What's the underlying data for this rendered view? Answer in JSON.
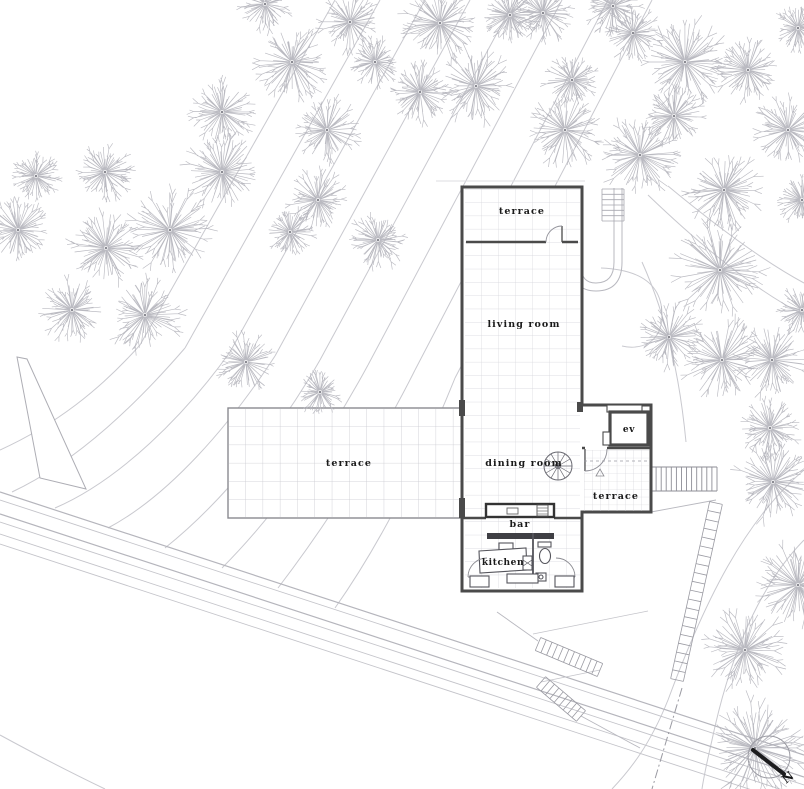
{
  "plan": {
    "rooms": [
      {
        "id": "terrace-top",
        "label": "terrace"
      },
      {
        "id": "living-room",
        "label": "living room"
      },
      {
        "id": "dining-room",
        "label": "dining room"
      },
      {
        "id": "terrace-west",
        "label": "terrace"
      },
      {
        "id": "terrace-east",
        "label": "terrace"
      },
      {
        "id": "bar",
        "label": "bar"
      },
      {
        "id": "kitchen",
        "label": "kitchen"
      },
      {
        "id": "elevator",
        "label": "ev"
      }
    ],
    "north_label": "N"
  },
  "colors": {
    "wall": "#4a4a4a",
    "grid_line": "#d4d4da",
    "terrace_grid": "#c9c9cf",
    "contour": "#c9c9cf",
    "road": "#bfbfc6",
    "tree": "#b2b2ba",
    "tree_center": "#8a8a92",
    "stair": "#9a9aa2",
    "label_text": "#1a1a1a",
    "north_arrow": "#1c1c1e"
  },
  "trees": [
    {
      "x": 265,
      "y": 4,
      "r": 26
    },
    {
      "x": 292,
      "y": 62,
      "r": 34
    },
    {
      "x": 350,
      "y": 22,
      "r": 28
    },
    {
      "x": 375,
      "y": 62,
      "r": 24
    },
    {
      "x": 222,
      "y": 112,
      "r": 30
    },
    {
      "x": 327,
      "y": 130,
      "r": 30
    },
    {
      "x": 36,
      "y": 176,
      "r": 22
    },
    {
      "x": 105,
      "y": 172,
      "r": 26
    },
    {
      "x": 222,
      "y": 172,
      "r": 36
    },
    {
      "x": 318,
      "y": 200,
      "r": 28
    },
    {
      "x": 18,
      "y": 230,
      "r": 28
    },
    {
      "x": 170,
      "y": 230,
      "r": 38
    },
    {
      "x": 106,
      "y": 248,
      "r": 34
    },
    {
      "x": 290,
      "y": 232,
      "r": 22
    },
    {
      "x": 378,
      "y": 240,
      "r": 26
    },
    {
      "x": 72,
      "y": 310,
      "r": 30
    },
    {
      "x": 145,
      "y": 315,
      "r": 34
    },
    {
      "x": 246,
      "y": 362,
      "r": 28
    },
    {
      "x": 320,
      "y": 392,
      "r": 20
    },
    {
      "x": 440,
      "y": 23,
      "r": 36
    },
    {
      "x": 510,
      "y": 15,
      "r": 26
    },
    {
      "x": 543,
      "y": 13,
      "r": 26
    },
    {
      "x": 613,
      "y": 6,
      "r": 26
    },
    {
      "x": 633,
      "y": 33,
      "r": 26
    },
    {
      "x": 685,
      "y": 62,
      "r": 40
    },
    {
      "x": 748,
      "y": 70,
      "r": 30
    },
    {
      "x": 798,
      "y": 28,
      "r": 22
    },
    {
      "x": 420,
      "y": 92,
      "r": 28
    },
    {
      "x": 476,
      "y": 86,
      "r": 34
    },
    {
      "x": 572,
      "y": 80,
      "r": 26
    },
    {
      "x": 565,
      "y": 130,
      "r": 34
    },
    {
      "x": 640,
      "y": 155,
      "r": 36
    },
    {
      "x": 674,
      "y": 116,
      "r": 28
    },
    {
      "x": 788,
      "y": 130,
      "r": 32
    },
    {
      "x": 724,
      "y": 190,
      "r": 36
    },
    {
      "x": 802,
      "y": 200,
      "r": 22
    },
    {
      "x": 720,
      "y": 270,
      "r": 44
    },
    {
      "x": 669,
      "y": 337,
      "r": 30
    },
    {
      "x": 722,
      "y": 360,
      "r": 38
    },
    {
      "x": 772,
      "y": 360,
      "r": 34
    },
    {
      "x": 802,
      "y": 310,
      "r": 24
    },
    {
      "x": 770,
      "y": 428,
      "r": 28
    },
    {
      "x": 773,
      "y": 482,
      "r": 36
    },
    {
      "x": 798,
      "y": 585,
      "r": 40
    },
    {
      "x": 745,
      "y": 650,
      "r": 38
    },
    {
      "x": 755,
      "y": 748,
      "r": 46
    }
  ]
}
